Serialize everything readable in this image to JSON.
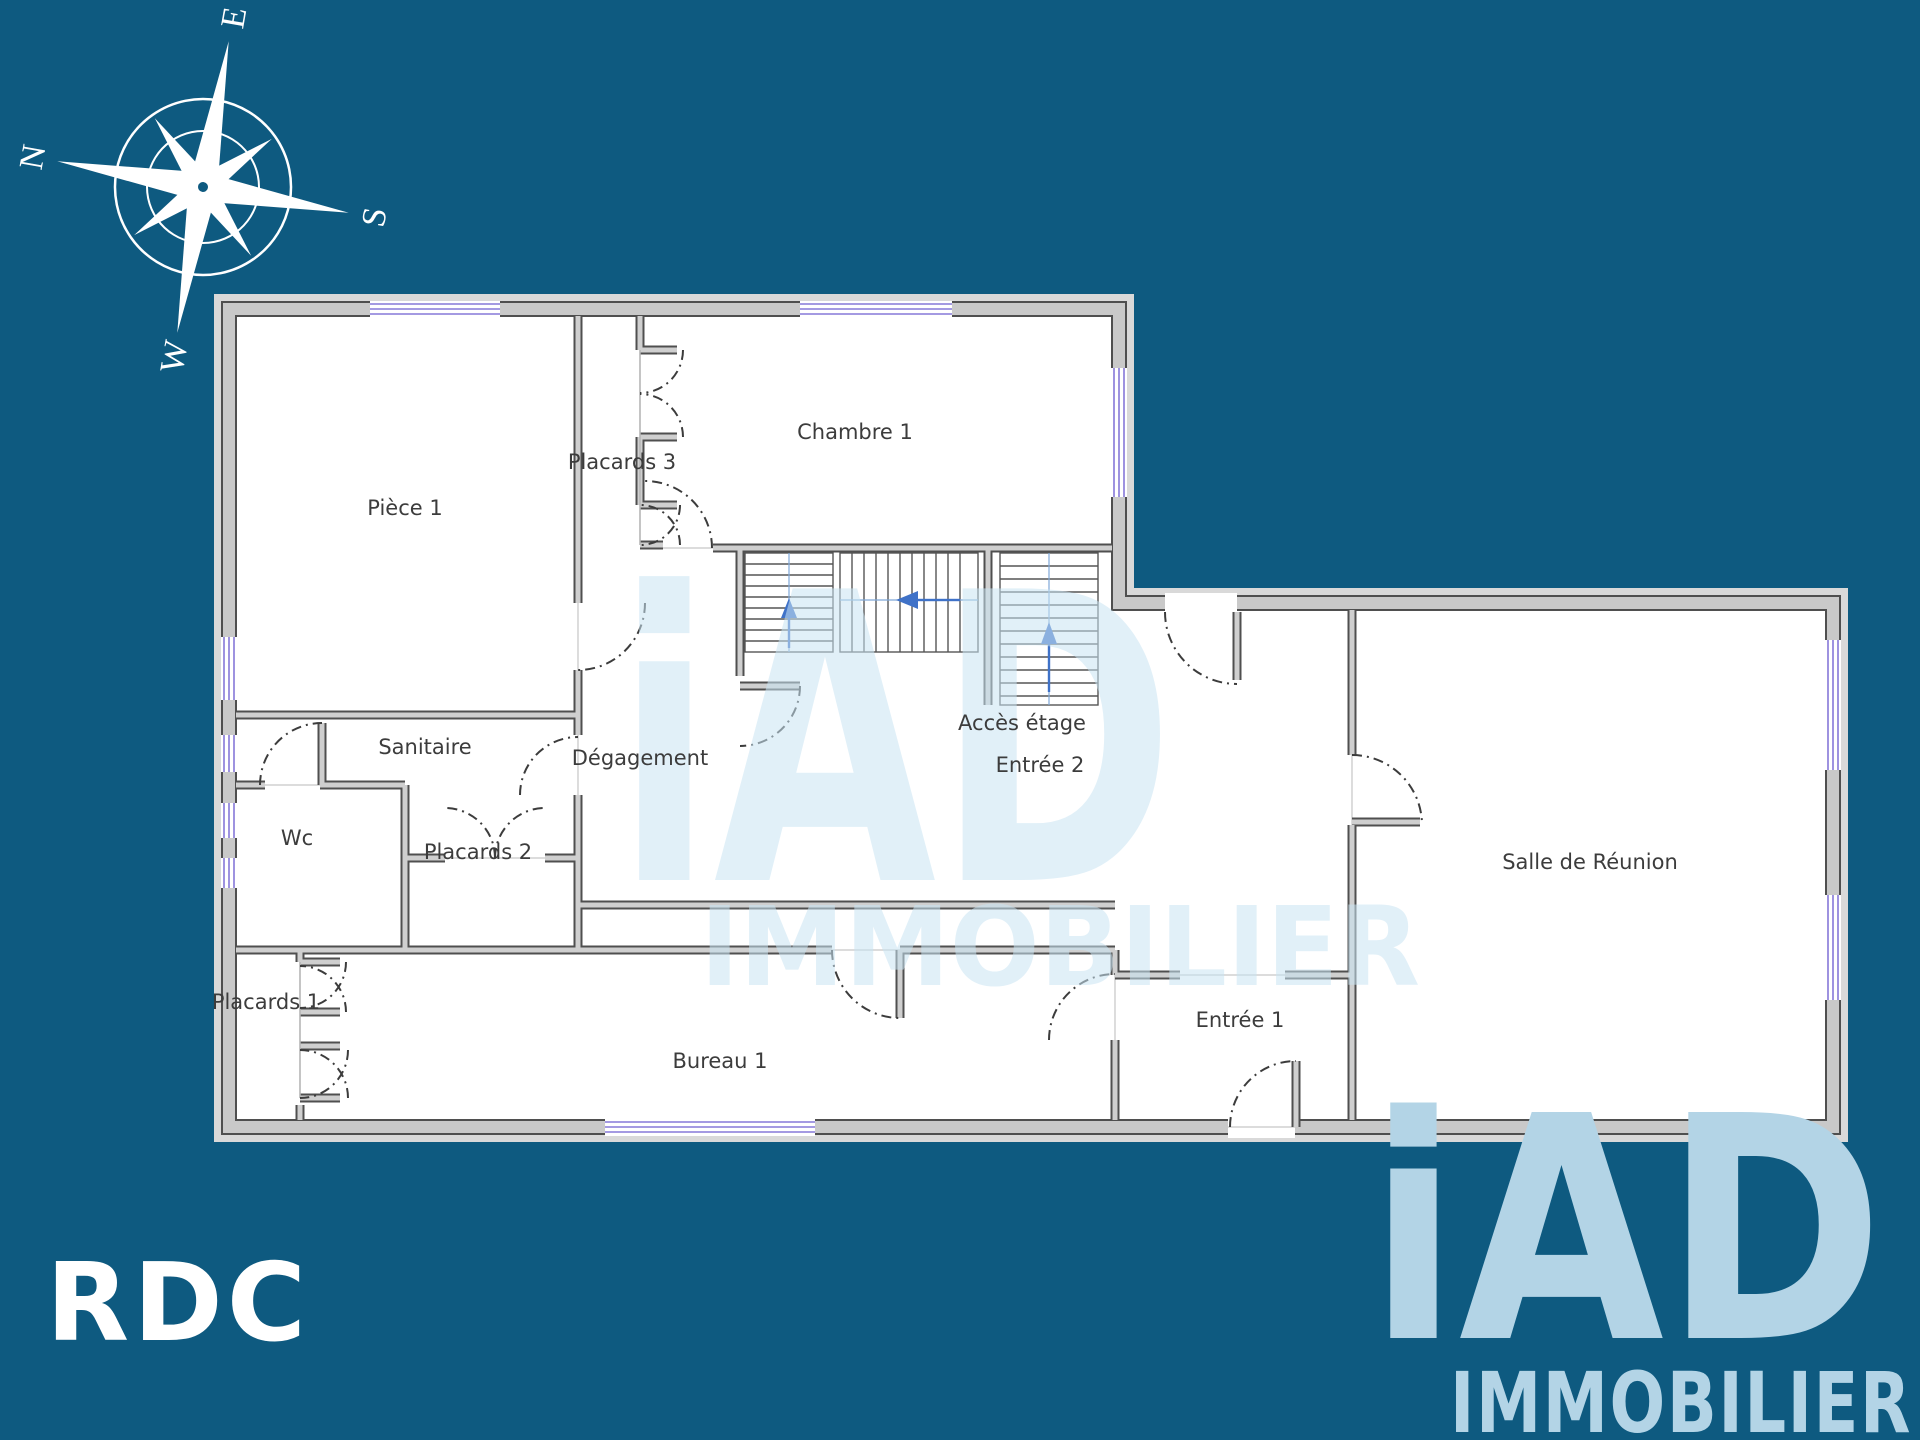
{
  "floor_label": "RDC",
  "compass": {
    "north": "N",
    "east": "E",
    "south": "S",
    "west": "W"
  },
  "rooms": [
    {
      "label": "Pièce 1"
    },
    {
      "label": "Placards 3"
    },
    {
      "label": "Chambre 1"
    },
    {
      "label": "Accès étage"
    },
    {
      "label": "Dégagement"
    },
    {
      "label": "Entrée 2"
    },
    {
      "label": "Sanitaire"
    },
    {
      "label": "Wc"
    },
    {
      "label": "Placards 2"
    },
    {
      "label": "Placards 1"
    },
    {
      "label": "Bureau 1"
    },
    {
      "label": "Entrée 1"
    },
    {
      "label": "Salle de Réunion"
    }
  ],
  "watermark": {
    "brand": "iAD",
    "subtitle": "IMMOBILIER"
  },
  "logo": {
    "brand": "iAD",
    "subtitle": "IMMOBILIER"
  },
  "colors": {
    "background": "#0e5a80",
    "wall_fill": "#c9c9c9",
    "wall_edge": "#4f4f4f",
    "window": "#8678d8",
    "stair_arrow": "#3f72c8",
    "logo_blue": "#b3d4e6",
    "label_text": "#3c3c3c"
  }
}
